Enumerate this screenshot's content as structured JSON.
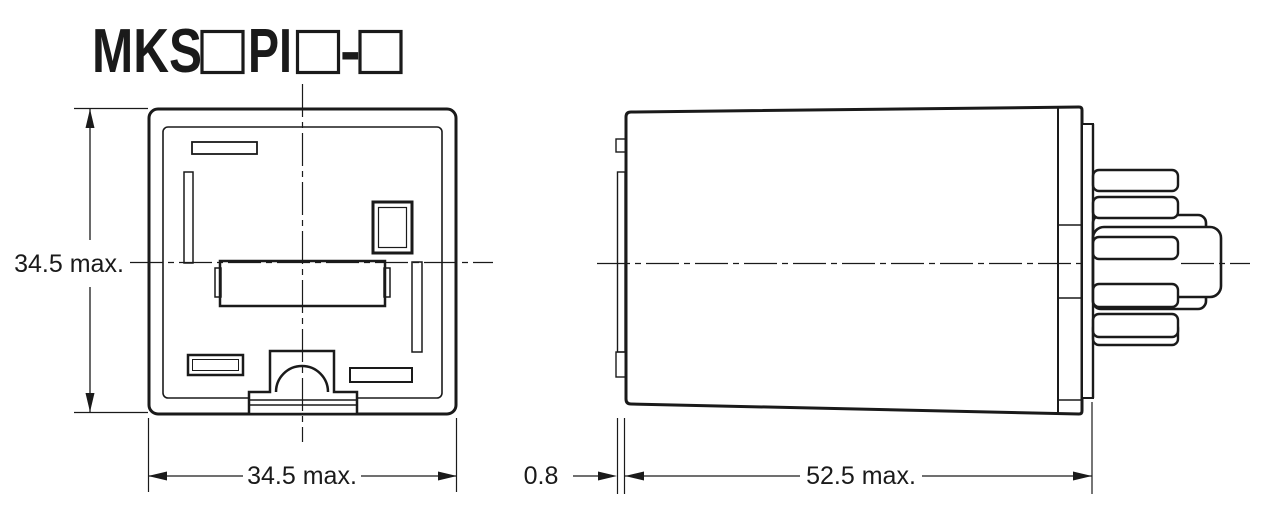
{
  "title": {
    "prefix": "MKS",
    "middle": "PI",
    "separator": "-"
  },
  "dimensions": {
    "front_height": "34.5 max.",
    "front_width": "34.5 max.",
    "panel_thickness": "0.8",
    "body_length": "52.5 max."
  },
  "colors": {
    "line": "#1a1a1a",
    "background": "#ffffff"
  }
}
